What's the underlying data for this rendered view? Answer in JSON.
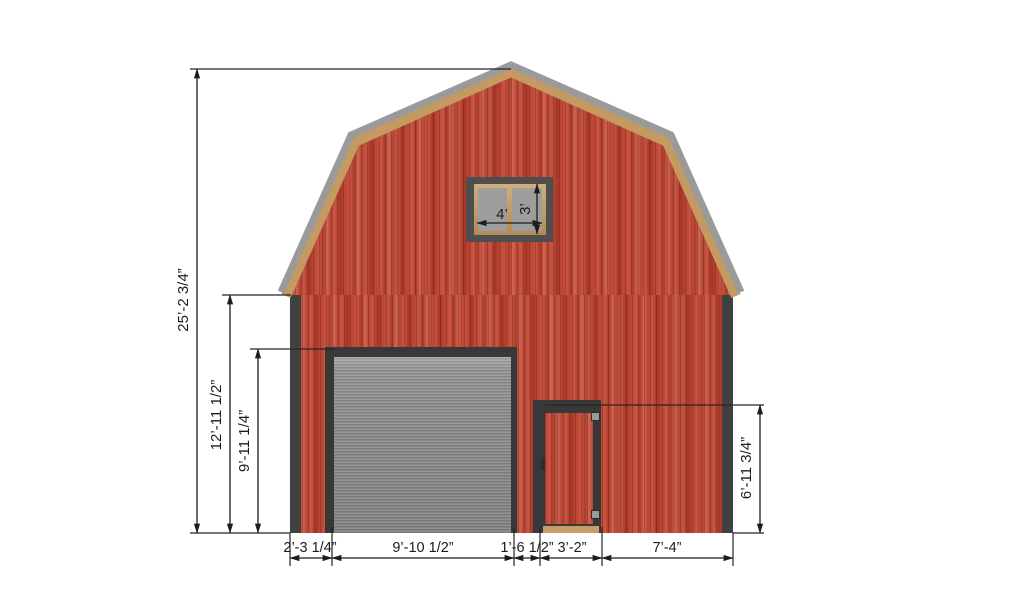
{
  "diagram": {
    "subject": "gambrel barn front elevation drawing",
    "dims": {
      "overall_height": "25’-2 3/4”",
      "wall_height": "12’-11 1/2”",
      "garage_door_height": "9’-11 1/4”",
      "side_door_height": "6’-11 3/4”",
      "window_width": "4’",
      "window_height": "3’",
      "left_offset": "2’-3 1/4”",
      "garage_door_width": "9’-10 1/2”",
      "door_gap": "1’-6 1/2”",
      "side_door_width": "3’-2”",
      "right_offset": "7’-4”"
    },
    "colors": {
      "background": "#ffffff",
      "siding_red": "#c04a3a",
      "trim_dark": "#3d3d3d",
      "roof_edge_gray": "#9a9a9a",
      "fascia_tan": "#c49a61",
      "garage_door_gray": "#8e8e8e",
      "window_glass_gray": "#9d9d9d",
      "threshold_tan": "#c79e66",
      "dimension_ink": "#1c1c1c"
    }
  }
}
